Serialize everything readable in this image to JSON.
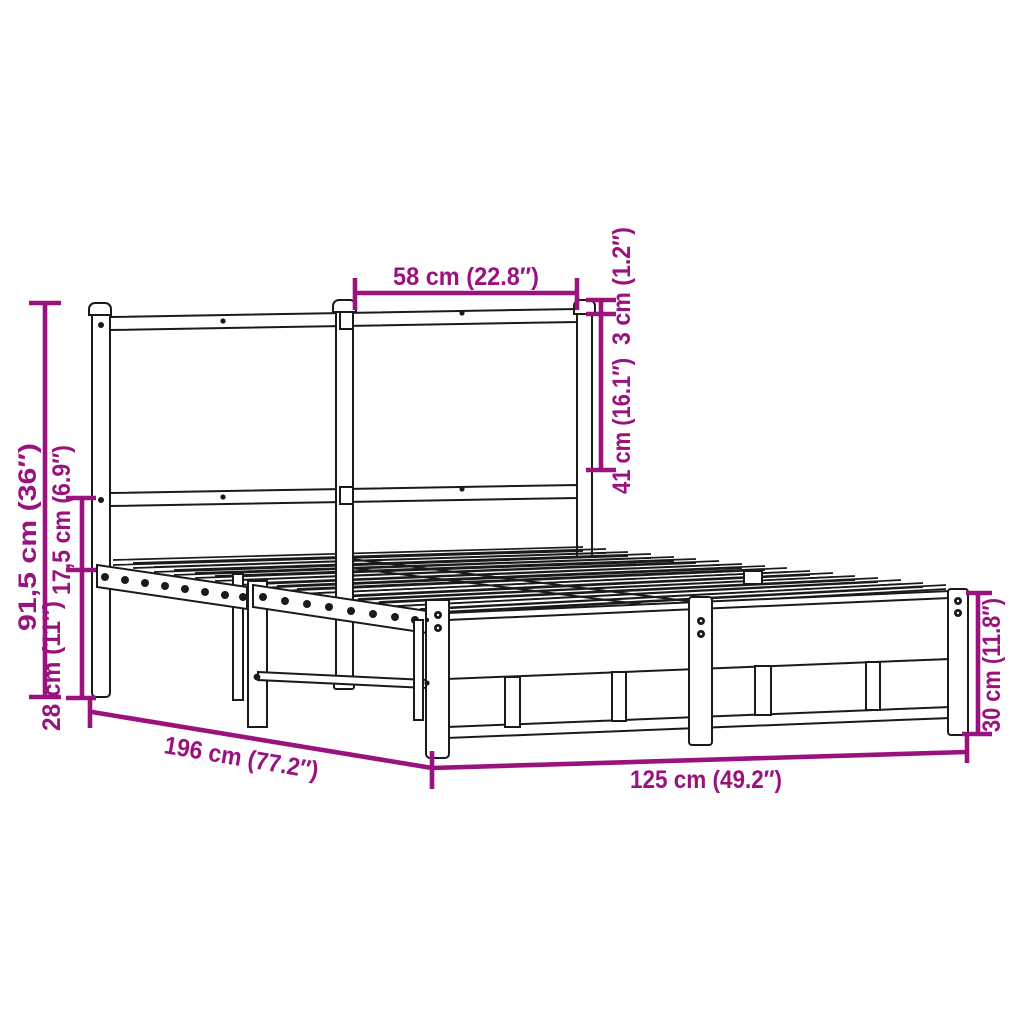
{
  "diagram": {
    "subject": "metal bed frame with headboard",
    "background_color": "#ffffff",
    "drawing_color": "#1a1a1a",
    "dimension_color": "#9a127e",
    "measurements": {
      "headboard_section_width": "58 cm (22.8″)",
      "headboard_cap_height": "3 cm (1.2″)",
      "headboard_panel_height": "41 cm (16.1″)",
      "headboard_total_height": "91,5 cm (36″)",
      "headboard_to_frame_gap": "17,5 cm (6.9″)",
      "under_frame_clearance": "28 cm (11″)",
      "frame_length": "196 cm (77.2″)",
      "frame_width": "125 cm (49.2″)",
      "foot_end_height": "30 cm (11.8″)"
    }
  }
}
